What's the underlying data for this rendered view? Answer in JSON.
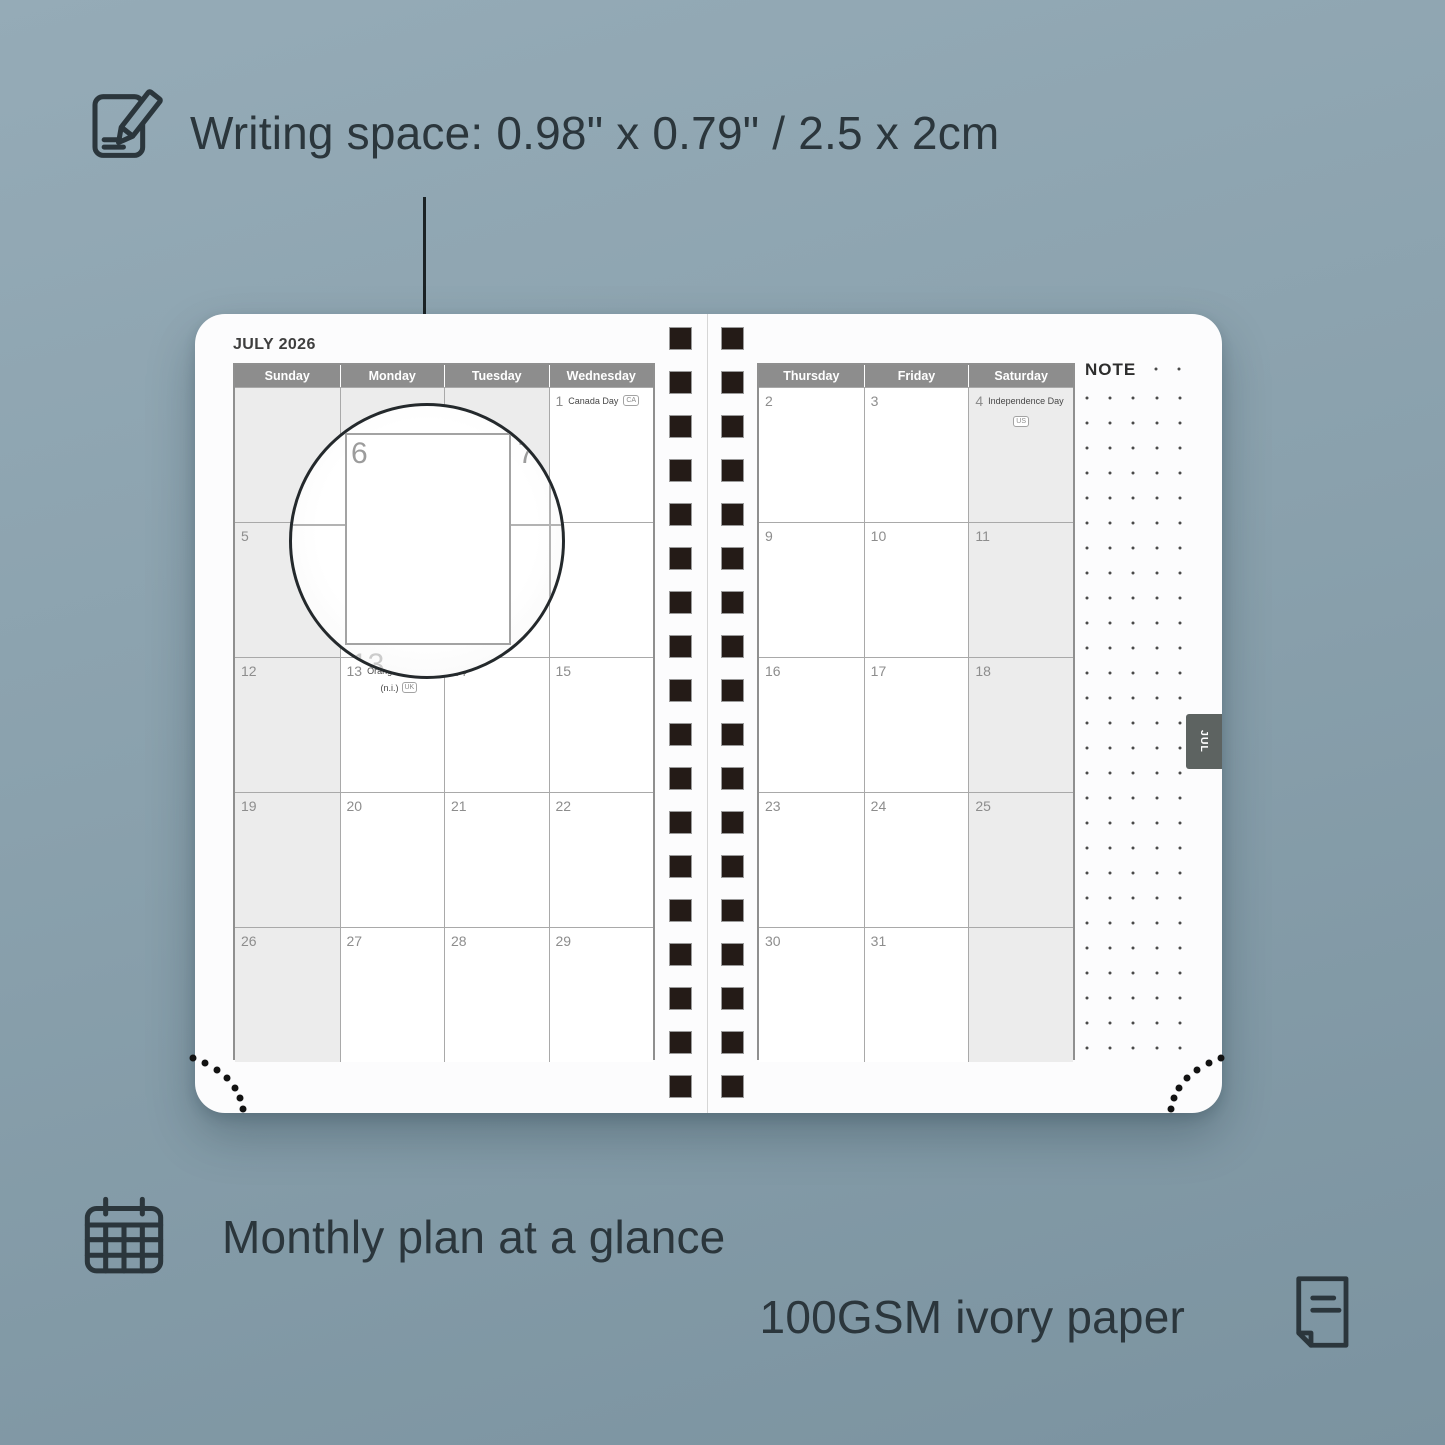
{
  "annotations": {
    "writing_space_label": "Writing space: 0.98\" x 0.79\" / 2.5 x 2cm",
    "monthly_plan_label": "Monthly plan at a glance",
    "paper_label": "100GSM ivory paper"
  },
  "planner": {
    "month_title": "JULY 2026",
    "note_label": "NOTE",
    "month_tab": "JUL",
    "left_day_headers": [
      "Sunday",
      "Monday",
      "Tuesday",
      "Wednesday"
    ],
    "right_day_headers": [
      "Thursday",
      "Friday",
      "Saturday"
    ],
    "left_weeks": [
      [
        {
          "blank": true
        },
        {
          "blank": true
        },
        {
          "blank": true
        },
        {
          "num": "1",
          "holiday": "Canada Day",
          "badge": "CA",
          "badge_pos": "inline"
        }
      ],
      [
        {
          "num": "5",
          "weekend": true
        },
        {
          "num": "6"
        },
        {
          "num": "7"
        },
        {
          "num": "8"
        }
      ],
      [
        {
          "num": "12",
          "weekend": true
        },
        {
          "num": "13",
          "holiday": "Orangemen's Day",
          "holiday_sub": "(n.i.)",
          "badge": "UK",
          "badge_pos": "sub"
        },
        {
          "num": "14"
        },
        {
          "num": "15"
        }
      ],
      [
        {
          "num": "19",
          "weekend": true
        },
        {
          "num": "20"
        },
        {
          "num": "21"
        },
        {
          "num": "22"
        }
      ],
      [
        {
          "num": "26",
          "weekend": true
        },
        {
          "num": "27"
        },
        {
          "num": "28"
        },
        {
          "num": "29"
        }
      ]
    ],
    "right_weeks": [
      [
        {
          "num": "2"
        },
        {
          "num": "3"
        },
        {
          "num": "4",
          "weekend": true,
          "holiday": "Independence Day",
          "badge": "US",
          "badge_pos": "below"
        }
      ],
      [
        {
          "num": "9"
        },
        {
          "num": "10"
        },
        {
          "num": "11",
          "weekend": true
        }
      ],
      [
        {
          "num": "16"
        },
        {
          "num": "17"
        },
        {
          "num": "18",
          "weekend": true
        }
      ],
      [
        {
          "num": "23"
        },
        {
          "num": "24"
        },
        {
          "num": "25",
          "weekend": true
        }
      ],
      [
        {
          "num": "30"
        },
        {
          "num": "31"
        },
        {
          "blank": true,
          "weekend": true
        }
      ]
    ],
    "note_grid": {
      "cols": 5,
      "rows": 27,
      "header_dots": 2
    },
    "spiral_squares_per_column": 18,
    "corner_dot_count": 7
  },
  "magnifier": {
    "top_left_day": "6",
    "top_right_day": "7",
    "bottom_day": "13"
  },
  "icons": {
    "top": "pencil-note-icon",
    "bottom_left": "calendar-grid-icon",
    "bottom_right": "paper-sheet-icon"
  },
  "colors": {
    "background_top": "#95abb7",
    "background_bottom": "#7b93a0",
    "ink": "#2b363c",
    "page_bg": "#fcfcfd",
    "header_bg": "#8d8d8d",
    "shaded_cell": "#ececec",
    "grid_line": "#a9a9a9",
    "day_number": "#8d8d8d",
    "spiral_square": "#241b17",
    "tab_bg": "#5d6361"
  }
}
